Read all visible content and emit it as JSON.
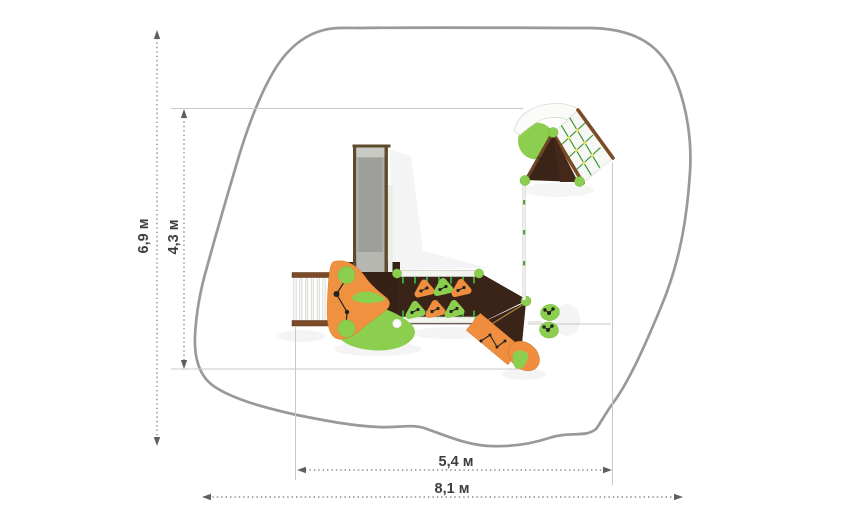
{
  "drawing": {
    "type": "playground-equipment-plan-top-view",
    "dimensions": {
      "overall_height_label": "6,9 м",
      "equipment_height_label": "4,3 м",
      "equipment_width_label": "5,4 м",
      "overall_width_label": "8,1 м"
    },
    "colors": {
      "safety_zone_outline": "#999999",
      "dimension_line": "#757575",
      "dimension_text": "#3e3e3e",
      "extension_line": "#c9c9c6",
      "deck_dark_brown": "#3a2418",
      "wood_brown": "#7b4a28",
      "accent_orange": "#ee8e3e",
      "accent_green": "#8ccf4e",
      "post_green": "#3f9e3f",
      "slide_gray": "#a8a9a1",
      "net_grid_green": "#2f8f2f",
      "net_dot_yellow": "#e6e155"
    }
  }
}
